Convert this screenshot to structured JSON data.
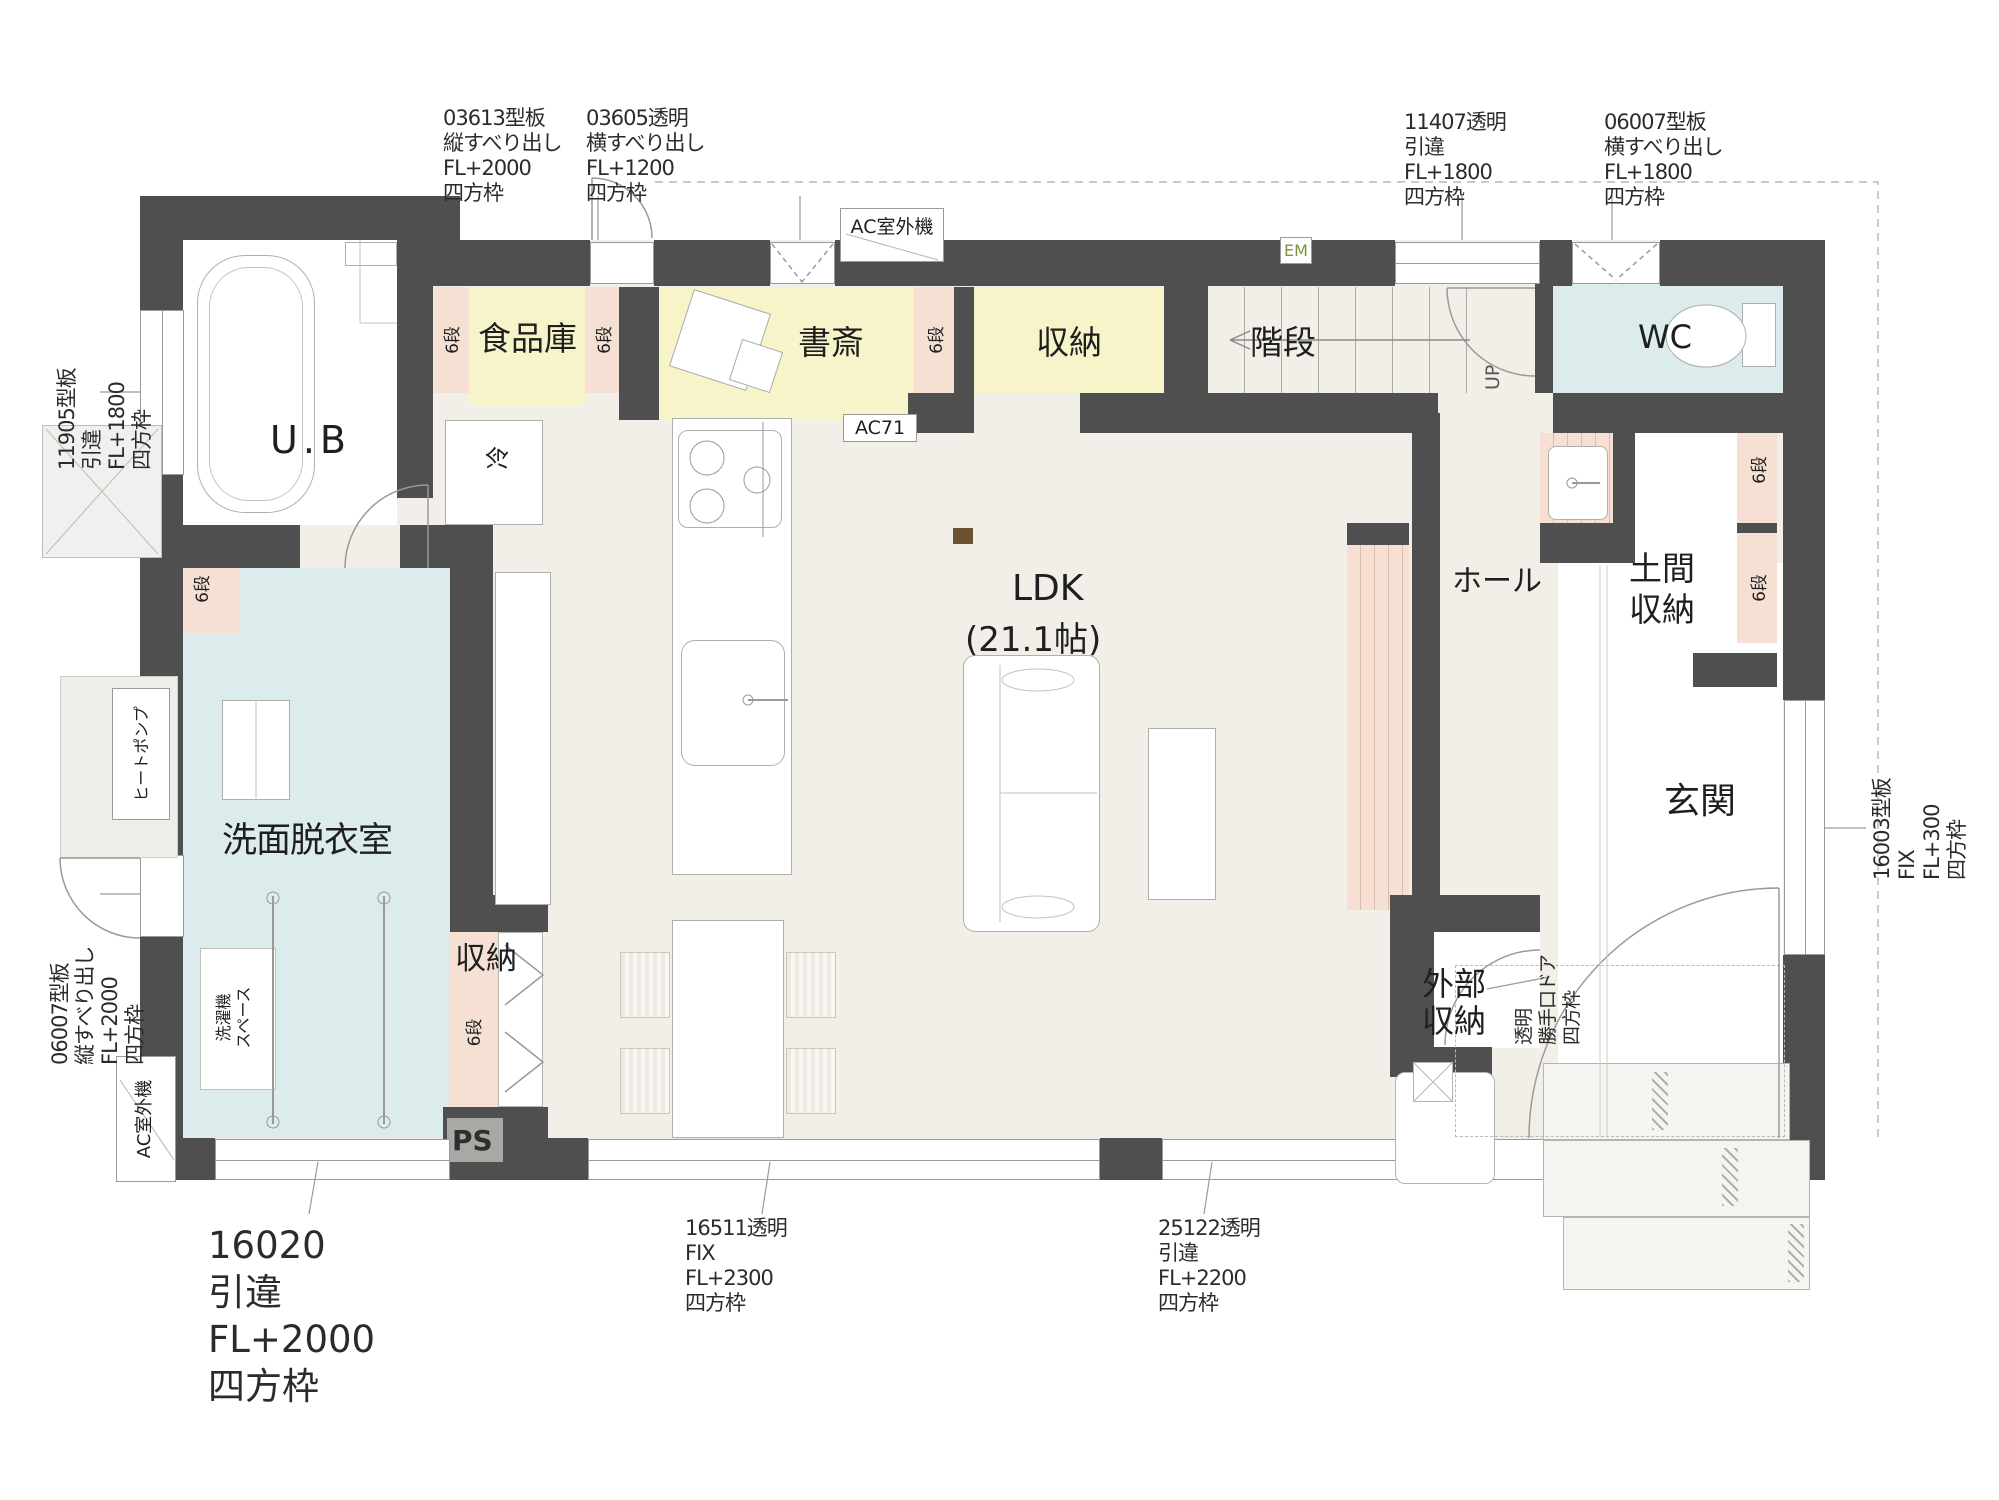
{
  "colors": {
    "wall": "#4f4f4f",
    "floor": "#f1efe7",
    "room_yellow": "#f7f4ca",
    "shelf_pink": "#f5e0d3",
    "room_blue": "#dcebec",
    "em_green": "#78963c"
  },
  "rooms": {
    "ub": {
      "label": "U.B"
    },
    "pantry": {
      "label": "食品庫"
    },
    "study": {
      "label": "書斎"
    },
    "storage_top": {
      "label": "収納"
    },
    "stairs": {
      "label": "階段",
      "up": "UP"
    },
    "wc": {
      "label": "WC"
    },
    "hall": {
      "label": "ホール"
    },
    "doma": {
      "line1": "土間",
      "line2": "収納"
    },
    "genkan": {
      "label": "玄関"
    },
    "ldk": {
      "name": "LDK",
      "size": "(21.1帖)"
    },
    "washroom": {
      "label": "洗面脱衣室"
    },
    "storage_bottom": {
      "label": "収納"
    },
    "ext_storage": {
      "line1": "外部",
      "line2": "収納"
    },
    "ps": {
      "label": "PS"
    }
  },
  "equipment": {
    "ac_outdoor_top": "AC室外機",
    "ac_outdoor_left": "AC室外機",
    "ac71": "AC71",
    "em": "EM",
    "fridge": "冷",
    "heat_pump": "ヒートポンプ",
    "washer_line1": "洗濯機",
    "washer_line2": "スペース",
    "shelf6": "6段"
  },
  "windows": {
    "w03613": {
      "l1": "03613型板",
      "l2": "縦すべり出し",
      "l3": "FL+2000",
      "l4": "四方枠"
    },
    "w03605": {
      "l1": "03605透明",
      "l2": "横すべり出し",
      "l3": "FL+1200",
      "l4": "四方枠"
    },
    "w11407": {
      "l1": "11407透明",
      "l2": "引違",
      "l3": "FL+1800",
      "l4": "四方枠"
    },
    "w06007_top": {
      "l1": "06007型板",
      "l2": "横すべり出し",
      "l3": "FL+1800",
      "l4": "四方枠"
    },
    "w11905": {
      "l1": "11905型板",
      "l2": "引違",
      "l3": "FL+1800",
      "l4": "四方枠"
    },
    "w06007_left": {
      "l1": "06007型板",
      "l2": "縦すべり出し",
      "l3": "FL+2000",
      "l4": "四方枠"
    },
    "w16020": {
      "l1": "16020",
      "l2": "引違",
      "l3": "FL+2000",
      "l4": "四方枠"
    },
    "w16511": {
      "l1": "16511透明",
      "l2": "FIX",
      "l3": "FL+2300",
      "l4": "四方枠"
    },
    "w25122": {
      "l1": "25122透明",
      "l2": "引違",
      "l3": "FL+2200",
      "l4": "四方枠"
    },
    "w16003": {
      "l1": "16003型板",
      "l2": "FIX",
      "l3": "FL+300",
      "l4": "四方枠"
    },
    "door_kitchen": {
      "l1": "透明",
      "l2": "勝手口ドア",
      "l3": "四方枠"
    }
  }
}
